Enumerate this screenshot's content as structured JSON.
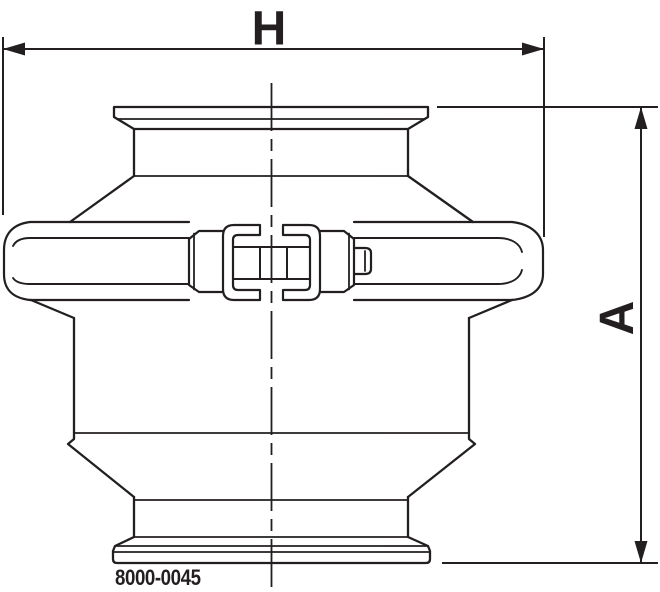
{
  "figure": {
    "type": "technical-drawing",
    "width_dim_label": "H",
    "height_dim_label": "A",
    "part_number": "8000-0045",
    "line_color": "#231f20",
    "background_color": "#ffffff"
  }
}
